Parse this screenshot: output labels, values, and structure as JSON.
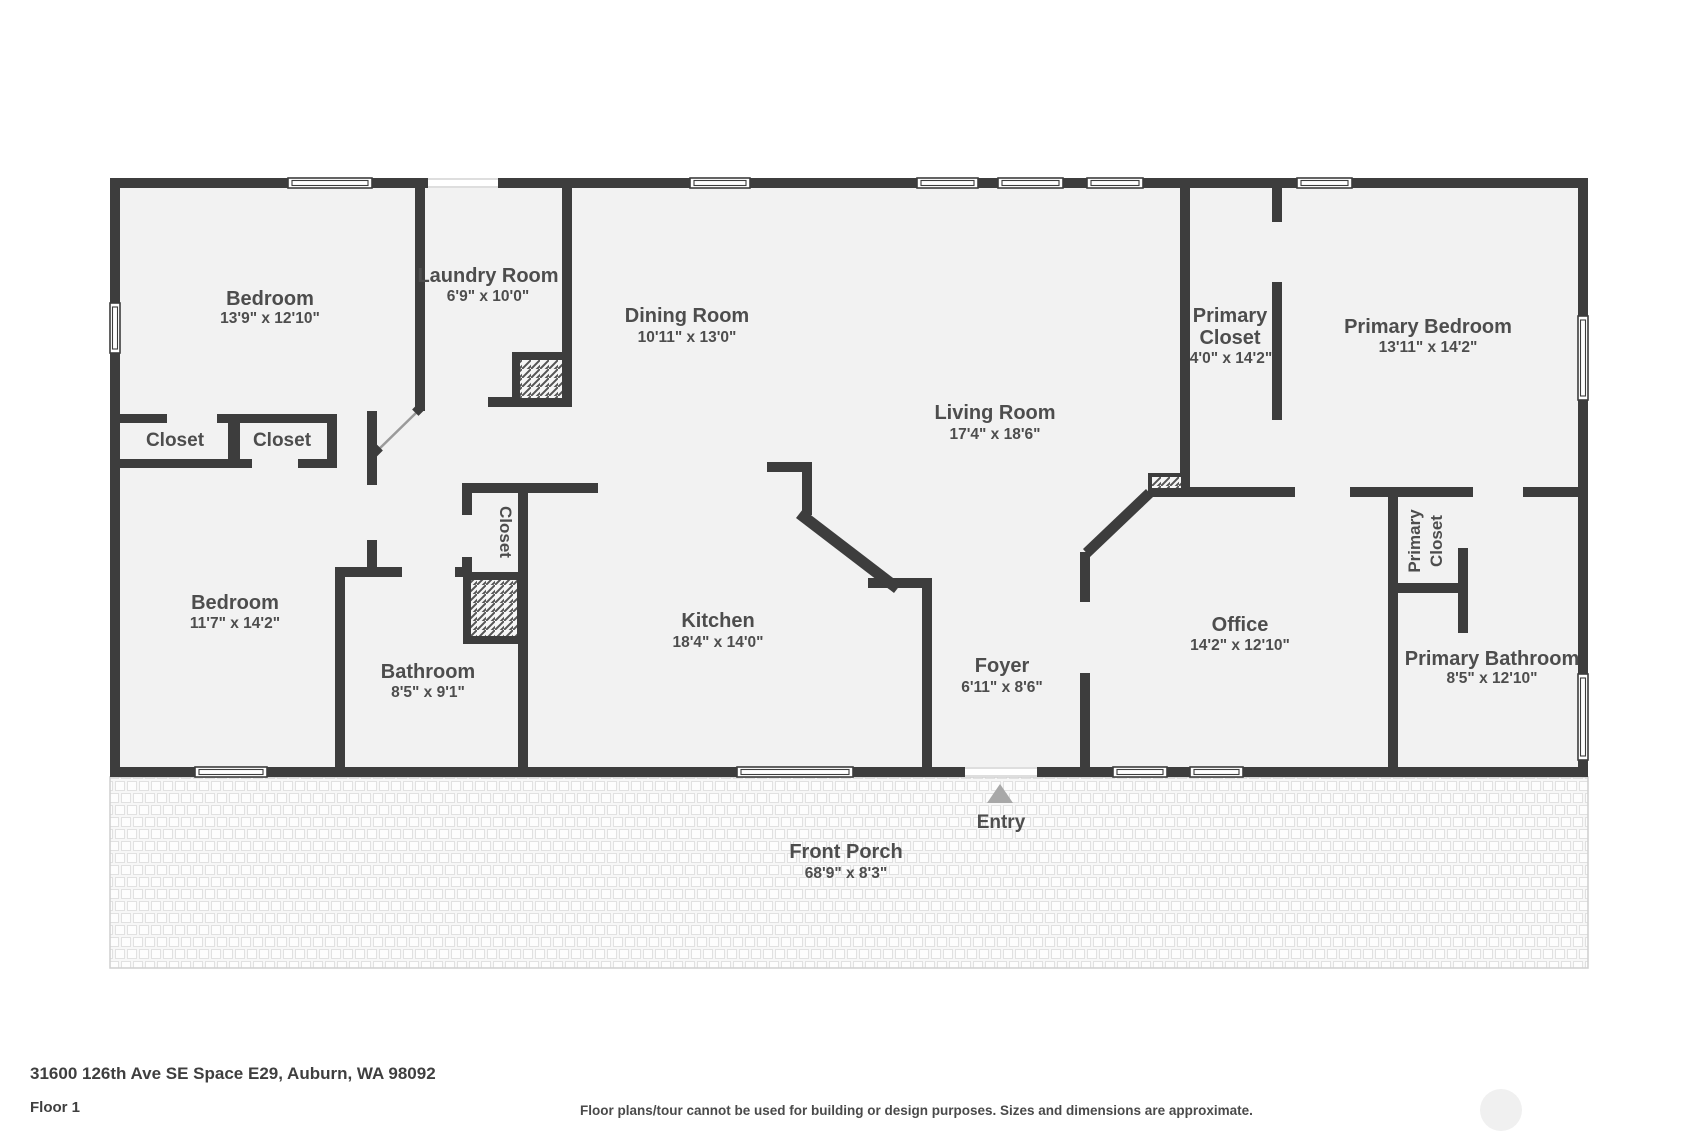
{
  "page": {
    "address": "31600 126th Ave SE Space E29, Auburn, WA 98092",
    "floor_label": "Floor 1",
    "disclaimer": "Floor plans/tour cannot be used for building or design purposes. Sizes and dimensions are approximate."
  },
  "rooms": {
    "bedroom_top": {
      "name": "Bedroom",
      "dims": "13'9\" x 12'10\""
    },
    "laundry": {
      "name": "Laundry Room",
      "dims": "6'9\" x 10'0\""
    },
    "dining": {
      "name": "Dining Room",
      "dims": "10'11\" x 13'0\""
    },
    "living": {
      "name": "Living Room",
      "dims": "17'4\" x 18'6\""
    },
    "primary_closet_top": {
      "name_line1": "Primary",
      "name_line2": "Closet",
      "dims": "4'0\" x 14'2\""
    },
    "primary_bedroom": {
      "name": "Primary Bedroom",
      "dims": "13'11\" x 14'2\""
    },
    "closet_a": {
      "name": "Closet"
    },
    "closet_b": {
      "name": "Closet"
    },
    "bedroom_lower": {
      "name": "Bedroom",
      "dims": "11'7\" x 14'2\""
    },
    "closet_hall": {
      "name": "Closet"
    },
    "bathroom": {
      "name": "Bathroom",
      "dims": "8'5\" x 9'1\""
    },
    "kitchen": {
      "name": "Kitchen",
      "dims": "18'4\" x 14'0\""
    },
    "foyer": {
      "name": "Foyer",
      "dims": "6'11\" x 8'6\""
    },
    "office": {
      "name": "Office",
      "dims": "14'2\" x 12'10\""
    },
    "primary_closet_lower": {
      "name_line1": "Primary",
      "name_line2": "Closet"
    },
    "primary_bathroom": {
      "name": "Primary Bathroom",
      "dims": "8'5\" x 12'10\""
    },
    "front_porch": {
      "name": "Front Porch",
      "dims": "68'9\" x 8'3\""
    }
  },
  "markers": {
    "entry_label": "Entry"
  },
  "colors": {
    "wall": "#3d3d3d",
    "room_fill": "#f2f2f2",
    "label": "#4d4d4d",
    "entry_arrow": "#a8a8a8"
  }
}
